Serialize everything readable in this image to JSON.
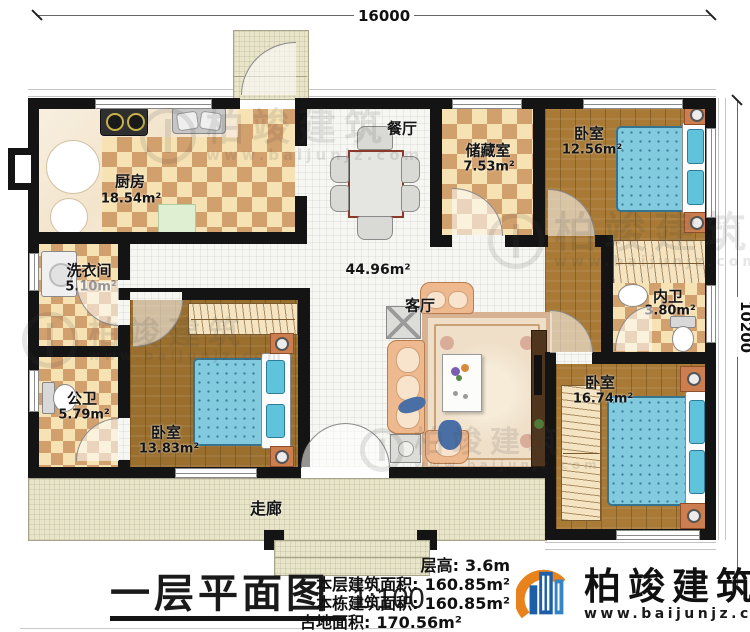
{
  "dimensions": {
    "width": "16000",
    "height": "10200"
  },
  "rooms": [
    {
      "id": "kitchen",
      "name": "厨房",
      "area": "18.54m²"
    },
    {
      "id": "dining",
      "name": "餐厅",
      "area": ""
    },
    {
      "id": "storage",
      "name": "储藏室",
      "area": "7.53m²"
    },
    {
      "id": "bedroom-ne",
      "name": "卧室",
      "area": "12.56m²"
    },
    {
      "id": "living",
      "name": "客厅",
      "area": "44.96m²"
    },
    {
      "id": "laundry",
      "name": "洗衣间",
      "area": "5.10m²"
    },
    {
      "id": "bath-public",
      "name": "公卫",
      "area": "5.79m²"
    },
    {
      "id": "bedroom-sw",
      "name": "卧室",
      "area": "13.83m²"
    },
    {
      "id": "bath-inner",
      "name": "内卫",
      "area": "3.80m²"
    },
    {
      "id": "bedroom-se",
      "name": "卧室",
      "area": "16.74m²"
    },
    {
      "id": "corridor",
      "name": "走廊",
      "area": ""
    }
  ],
  "title_block": {
    "title": "一层平面图",
    "scale": "1:100"
  },
  "stats": {
    "rows": [
      {
        "label": "层高:",
        "value": "3.6m"
      },
      {
        "label": "本层建筑面积:",
        "value": "160.85m²"
      },
      {
        "label": "本栋建筑面积:",
        "value": "160.85m²"
      },
      {
        "label": "占地面积:",
        "value": "170.56m²"
      }
    ]
  },
  "brand": {
    "name": "柏竣建筑",
    "website": "www.baijunjz.com"
  },
  "watermark": {
    "name": "柏竣建筑",
    "website": "www.baijunjz.com"
  },
  "colors": {
    "wall": "#141414",
    "tile_tan": "#d2a06d",
    "tile_cream": "#f7e2b3",
    "wood": "#a87a35",
    "bed_blue": "#82cade",
    "brand_blue": "#1c5fa8",
    "brand_orange": "#e8821c"
  }
}
